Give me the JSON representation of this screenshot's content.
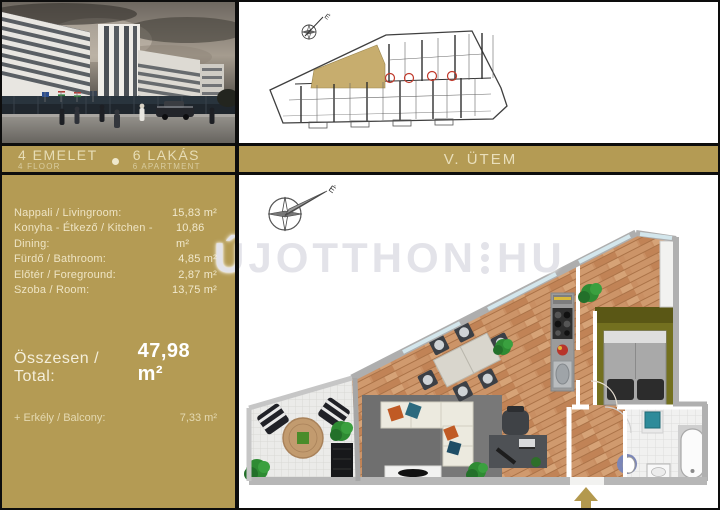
{
  "header": {
    "floor": {
      "hu": "4 EMELET",
      "en": "4 FLOOR"
    },
    "apartments": {
      "hu": "6 LAKÁS",
      "en": "6 APARTMENT"
    },
    "phase": "V. ÜTEM"
  },
  "watermark": {
    "left": "ÚJOTTHON",
    "right": "HU"
  },
  "compass": {
    "north": "É"
  },
  "areas": {
    "rooms": [
      {
        "label": "Nappali / Livingroom:",
        "value": "15,83 m²"
      },
      {
        "label": "Konyha - Étkező / Kitchen - Dining:",
        "value": "10,86 m²"
      },
      {
        "label": "Fürdő / Bathroom:",
        "value": "4,85 m²"
      },
      {
        "label": "Előtér / Foreground:",
        "value": "2,87 m²"
      },
      {
        "label": "Szoba / Room:",
        "value": "13,75 m²"
      }
    ],
    "total": {
      "label": "Összesen / Total:",
      "value": "47,98 m²"
    },
    "balcony": {
      "label": "+  Erkély / Balcony:",
      "value": "7,33 m²"
    }
  },
  "colors": {
    "gold": "#b49b54",
    "wood": "#c98f63",
    "olive": "#6f6b20",
    "highlight": "#c7ad6e"
  }
}
